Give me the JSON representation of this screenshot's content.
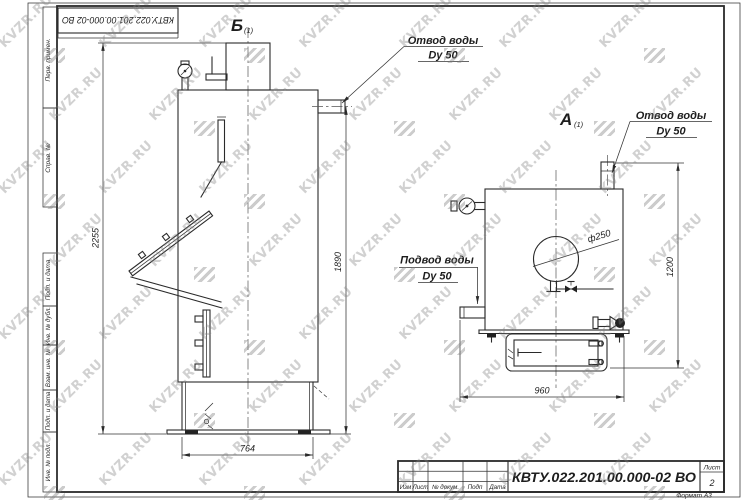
{
  "watermark": {
    "text": "KVZR.RU"
  },
  "top_stamp": {
    "doc_number": "КВТУ.022.201.00.000-02  ВО"
  },
  "margin": {
    "labels": [
      "Перв. примен.",
      "Справ. №",
      "Подп. и дата",
      "Инв. № дубл.",
      "Взам. инв. №",
      "Подп. и дата",
      "Инв. № подл."
    ]
  },
  "view_b": {
    "label": "Б",
    "label_index": "(1)",
    "callout_outlet": {
      "line1": "Отвод воды",
      "line2": "Dy 50"
    },
    "dim_total_height": "2255",
    "dim_outlet_height": "1890",
    "dim_base_width": "764"
  },
  "view_a": {
    "label": "А",
    "label_index": "(1)",
    "callout_outlet": {
      "line1": "Отвод воды",
      "line2": "Dy 50"
    },
    "callout_inlet": {
      "line1": "Подвод воды",
      "line2": "Dy 50"
    },
    "dim_outlet_height": "1200",
    "dim_width": "960",
    "dim_diameter": "ф250"
  },
  "title_block": {
    "doc_number": "КВТУ.022.201.00.000-02  ВО",
    "columns": [
      "Изм",
      "Лист",
      "№ докум.",
      "Подп",
      "Дата"
    ],
    "sheet_label": "Лист",
    "sheet_number": "2",
    "format_label": "Формат А3"
  }
}
